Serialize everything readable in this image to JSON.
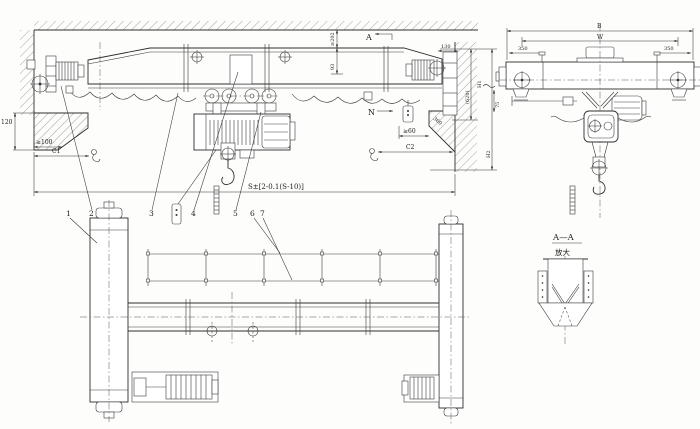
{
  "front": {
    "dim_ceiling_gap": "≥202",
    "dim_93": "93",
    "dim_120": "120",
    "dim_min100": "≥100",
    "dim_c1": "C1",
    "dim_c2": "C2",
    "dim_span": "S±[2-0.1(S-10)]",
    "dim_360": "360",
    "dim_min60": "≥60",
    "dim_130": "130",
    "dim_620": "(620)",
    "dim_h1": "H1",
    "dim_h2": "H2",
    "marker_a": "A",
    "marker_n": "N"
  },
  "end": {
    "dim_b": "B",
    "dim_w": "W",
    "dim_350_left": "350",
    "dim_350_right": "350",
    "dim_75": "75"
  },
  "plan": {
    "parts": [
      "1",
      "2",
      "3",
      "4",
      "5",
      "6",
      "7"
    ]
  },
  "section": {
    "title": "A—A",
    "note": "放大"
  }
}
